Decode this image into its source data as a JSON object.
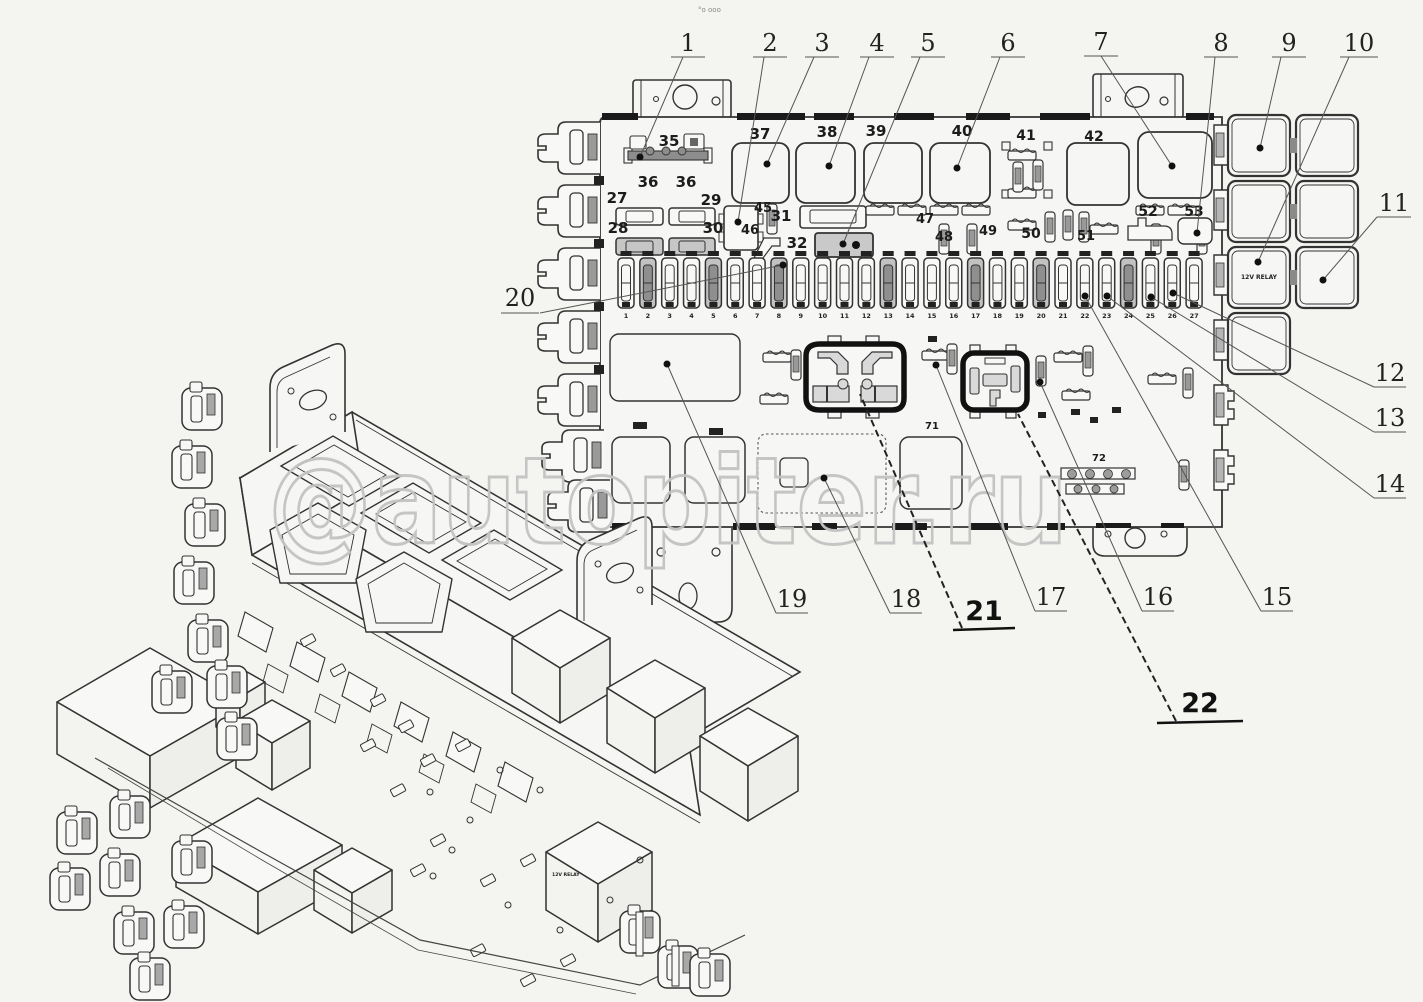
{
  "page": {
    "background": "#f4f4f1",
    "line_color": "#333333",
    "dark_fill": "#1a1a1a",
    "watermark_text": "@autopiter.ru",
    "watermark_color": "#c3c3c3",
    "artifact_text": "°o ooo"
  },
  "callouts": {
    "c1": "1",
    "c2": "2",
    "c3": "3",
    "c4": "4",
    "c5": "5",
    "c6": "6",
    "c7": "7",
    "c8": "8",
    "c9": "9",
    "c10": "10",
    "c11": "11",
    "c12": "12",
    "c13": "13",
    "c14": "14",
    "c15": "15",
    "c16": "16",
    "c17": "17",
    "c18": "18",
    "c19": "19",
    "c20": "20",
    "c21": "21",
    "c22": "22"
  },
  "flat_view": {
    "relay_cell_label": "12V RELAY",
    "fuse_numbers": [
      "1",
      "2",
      "3",
      "4",
      "5",
      "6",
      "7",
      "8",
      "9",
      "10",
      "11",
      "12",
      "13",
      "14",
      "15",
      "16",
      "17",
      "18",
      "19",
      "20",
      "21",
      "22",
      "23",
      "24",
      "25",
      "26",
      "27"
    ],
    "part_labels": {
      "l27": "27",
      "l28": "28",
      "l29": "29",
      "l30": "30",
      "l31": "31",
      "l32": "32",
      "l35": "35",
      "l36a": "36",
      "l36b": "36",
      "l37": "37",
      "l38": "38",
      "l39": "39",
      "l40": "40",
      "l41": "41",
      "l42": "42",
      "l45": "45",
      "l46": "46",
      "l47": "47",
      "l48": "48",
      "l49": "49",
      "l50": "50",
      "l51": "51",
      "l52": "52",
      "l53": "53",
      "l71": "71",
      "l72": "72"
    }
  },
  "iso_view": {
    "relay_text": "12V RELAY"
  }
}
